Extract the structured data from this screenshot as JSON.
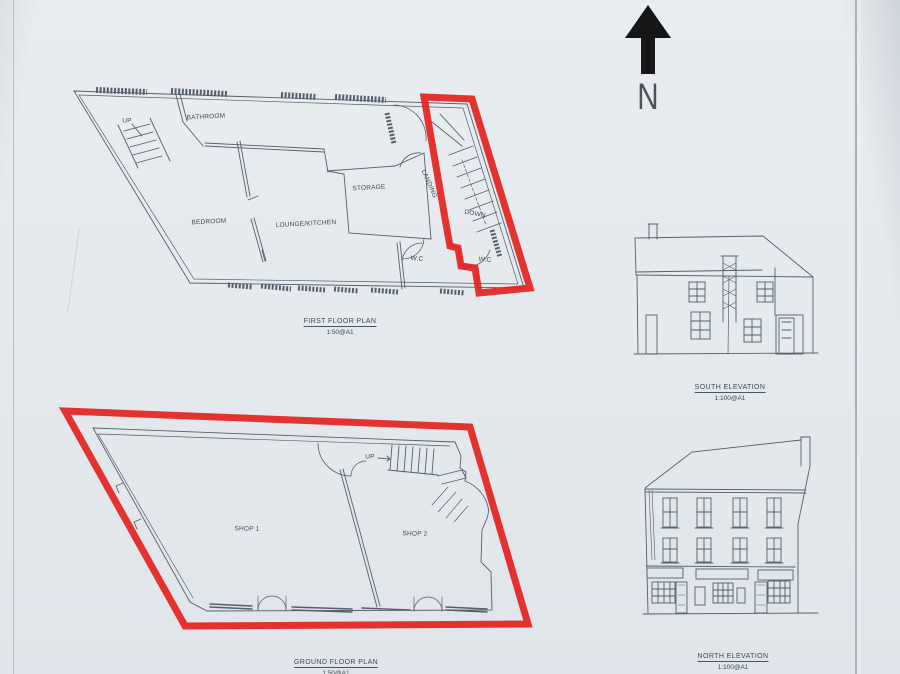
{
  "colors": {
    "paper": "#e7ebee",
    "pencil_line": "#4d5864",
    "highlight_red": "#e42220",
    "north_arrow_black": "#161616"
  },
  "north_arrow": {
    "label": "N"
  },
  "first_floor_plan": {
    "title": "FIRST FLOOR PLAN",
    "scale": "1:50@A1",
    "labels": {
      "up": "UP",
      "bathroom": "BATHROOM",
      "bedroom": "BEDROOM",
      "lounge_kitchen": "LOUNGE/KITCHEN",
      "storage": "STORAGE",
      "landing": "LANDING",
      "down": "DOWN",
      "wc_left": "W.C",
      "wc_right": "W.C"
    }
  },
  "ground_floor_plan": {
    "title": "GROUND FLOOR PLAN",
    "scale": "1:50@A1",
    "labels": {
      "up": "UP",
      "shop1": "SHOP 1",
      "shop2": "SHOP 2"
    }
  },
  "south_elevation": {
    "title": "SOUTH ELEVATION",
    "scale": "1:100@A1"
  },
  "north_elevation": {
    "title": "NORTH ELEVATION",
    "scale": "1:100@A1"
  }
}
